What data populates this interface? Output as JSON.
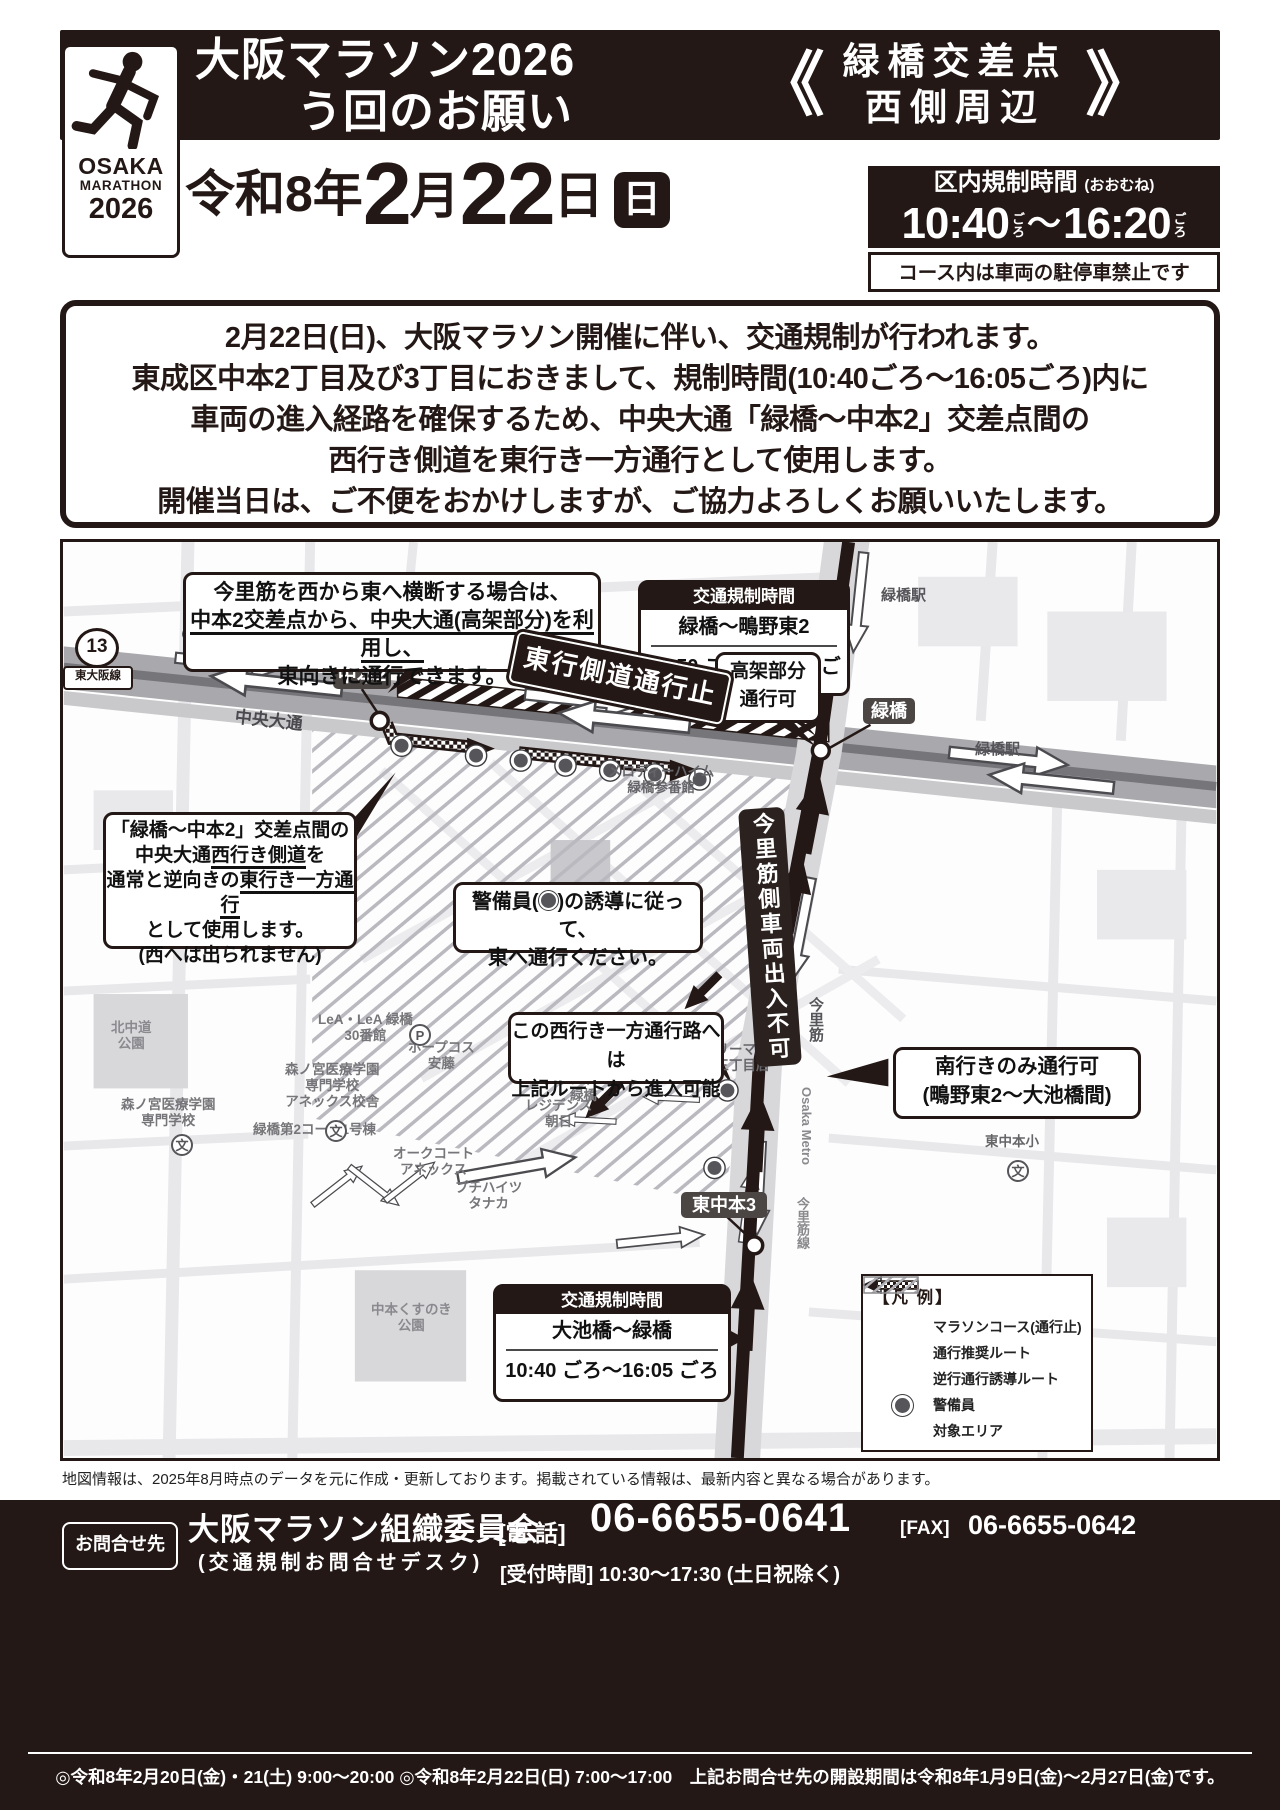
{
  "header": {
    "logo": {
      "line1": "OSAKA",
      "line2": "MARATHON",
      "line3": "2026"
    },
    "title_line1": "大阪マラソン2026",
    "title_line2": "う回のお願い",
    "bracket_open": "《",
    "bracket_close": "》",
    "area_line1": "緑橋交差点",
    "area_line2": "西側周辺",
    "date": {
      "era": "令和8年",
      "month": "2",
      "month_unit": "月",
      "day": "22",
      "day_unit": "日",
      "weekday": "日"
    },
    "restriction": {
      "title": "区内規制時間",
      "note": "(おおむね)",
      "time_start": "10:40",
      "approx1": "ごろ",
      "tilde": "～",
      "time_end": "16:20",
      "approx2": "ごろ",
      "no_parking": "コース内は車両の駐停車禁止です"
    }
  },
  "notice": {
    "lines": [
      "2月22日(日)、大阪マラソン開催に伴い、交通規制が行われます。",
      "東成区中本2丁目及び3丁目におきまして、規制時間(10:40ごろ～16:05ごろ)内に",
      "車両の進入経路を確保するため、中央大通「緑橋～中本2」交差点間の",
      "西行き側道を東行き一方通行として使用します。",
      "開催当日は、ご不便をおかけしますが、ご協力よろしくお願いいたします。"
    ]
  },
  "map": {
    "route13": {
      "number": "13",
      "name": "東大阪線"
    },
    "roads": {
      "chuo_odori": "中央大通",
      "metro_chuo": "Osaka Metro 中央線",
      "imazato_suji": "今里筋",
      "metro_imazato": "Osaka Metro",
      "imazato_line": "今里筋線"
    },
    "stations": {
      "midoribashi_top": "緑橋駅",
      "midoribashi_right": "緑橋駅"
    },
    "badges": {
      "nakamoto2": "中本2",
      "midoribashi": "緑橋",
      "higashinakamoto3": "東中本3",
      "imazato_no_entry": "今里筋側車両出入不可"
    },
    "banner": "東行側道通行止",
    "callouts": {
      "cross": {
        "line1": "今里筋を西から東へ横断する場合は、",
        "line2": "中本2交差点から、中央大通(高架部分)を利用し、",
        "line3": "東向きに通行できます。"
      },
      "reg_north": {
        "title": "交通規制時間",
        "section": "緑橋～鴫野東2",
        "time": "10:50 ごろ～16:20 ごろ"
      },
      "elevated": {
        "line1": "高架部分",
        "line2": "通行可"
      },
      "sideroad": {
        "line1": "「緑橋～中本2」交差点間の",
        "line2_pre": "中央大通",
        "line2_u": "西行き側道",
        "line2_post": "を",
        "line3_pre": "通常と逆向きの",
        "line3_u": "東行き一方通行",
        "line4": "として使用します。",
        "line5": "(西へは出られません)"
      },
      "guard": {
        "line1_pre": "警備員(",
        "line1_post": ")の誘導に従って、",
        "line2": "東へ通行ください。"
      },
      "south_only": {
        "line1": "南行きのみ通行可",
        "line2": "(鴫野東2～大池橋間)"
      },
      "entry": {
        "line1": "この西行き一方通行路へは",
        "line2": "上記ルートから進入可能"
      },
      "reg_south": {
        "title": "交通規制時間",
        "section": "大池橋～緑橋",
        "time": "10:40 ごろ～16:05 ごろ"
      }
    },
    "places": {
      "melody": "メロディーハイム\n緑橋参番館",
      "lea": "LeA・LeA 緑橋\n30番館",
      "morinomiya_annex": "森ノ宮医療学園\n専門学校\nアネックス校舎",
      "familymart": "ファミリーマート\n中本三丁目店",
      "residence_asahi": "レジデンス\n朝日",
      "kitanakamichi_park": "北中道\n公園",
      "morinomiya": "森ノ宮医療学園\n専門学校",
      "hopecos_ando": "ホープコス\n安藤",
      "grandone": "グランドーネ\n緑橋",
      "rex_mansion": "緑橋レックス\nマンション",
      "corpo": "緑橋第2コーポ1号棟",
      "oakcourt": "オークコート\nアネックス",
      "petithights": "プチハイツ\nタナカ",
      "kusunoki_park": "中本くすのき\n公園",
      "higashinakamoto_elem": "東中本小",
      "school_mark": "文",
      "parking_mark": "P"
    },
    "legend": {
      "title": "【凡 例】",
      "items": [
        {
          "label": "マラソンコース(通行止)"
        },
        {
          "label": "通行推奨ルート"
        },
        {
          "label": "逆行通行誘導ルート"
        },
        {
          "label": "警備員"
        },
        {
          "label": "対象エリア"
        }
      ]
    }
  },
  "map_note": "地図情報は、2025年8月時点のデータを元に作成・更新しております。掲載されている情報は、最新内容と異なる場合があります。",
  "footer": {
    "label": "お問合せ先",
    "org": "大阪マラソン組織委員会",
    "desk": "(交通規制お問合せデスク)",
    "tel_label": "[電 話]",
    "tel": "06-6655-0641",
    "fax_label": "[FAX]",
    "fax": "06-6655-0642",
    "hours_label": "[受付時間]",
    "hours": "10:30～17:30 (土日祝除く)",
    "schedule": "◎令和8年2月20日(金)・21(土) 9:00～20:00 ◎令和8年2月22日(日) 7:00～17:00　上記お問合せ先の開設期間は令和8年1月9日(金)～2月27日(金)です。"
  }
}
